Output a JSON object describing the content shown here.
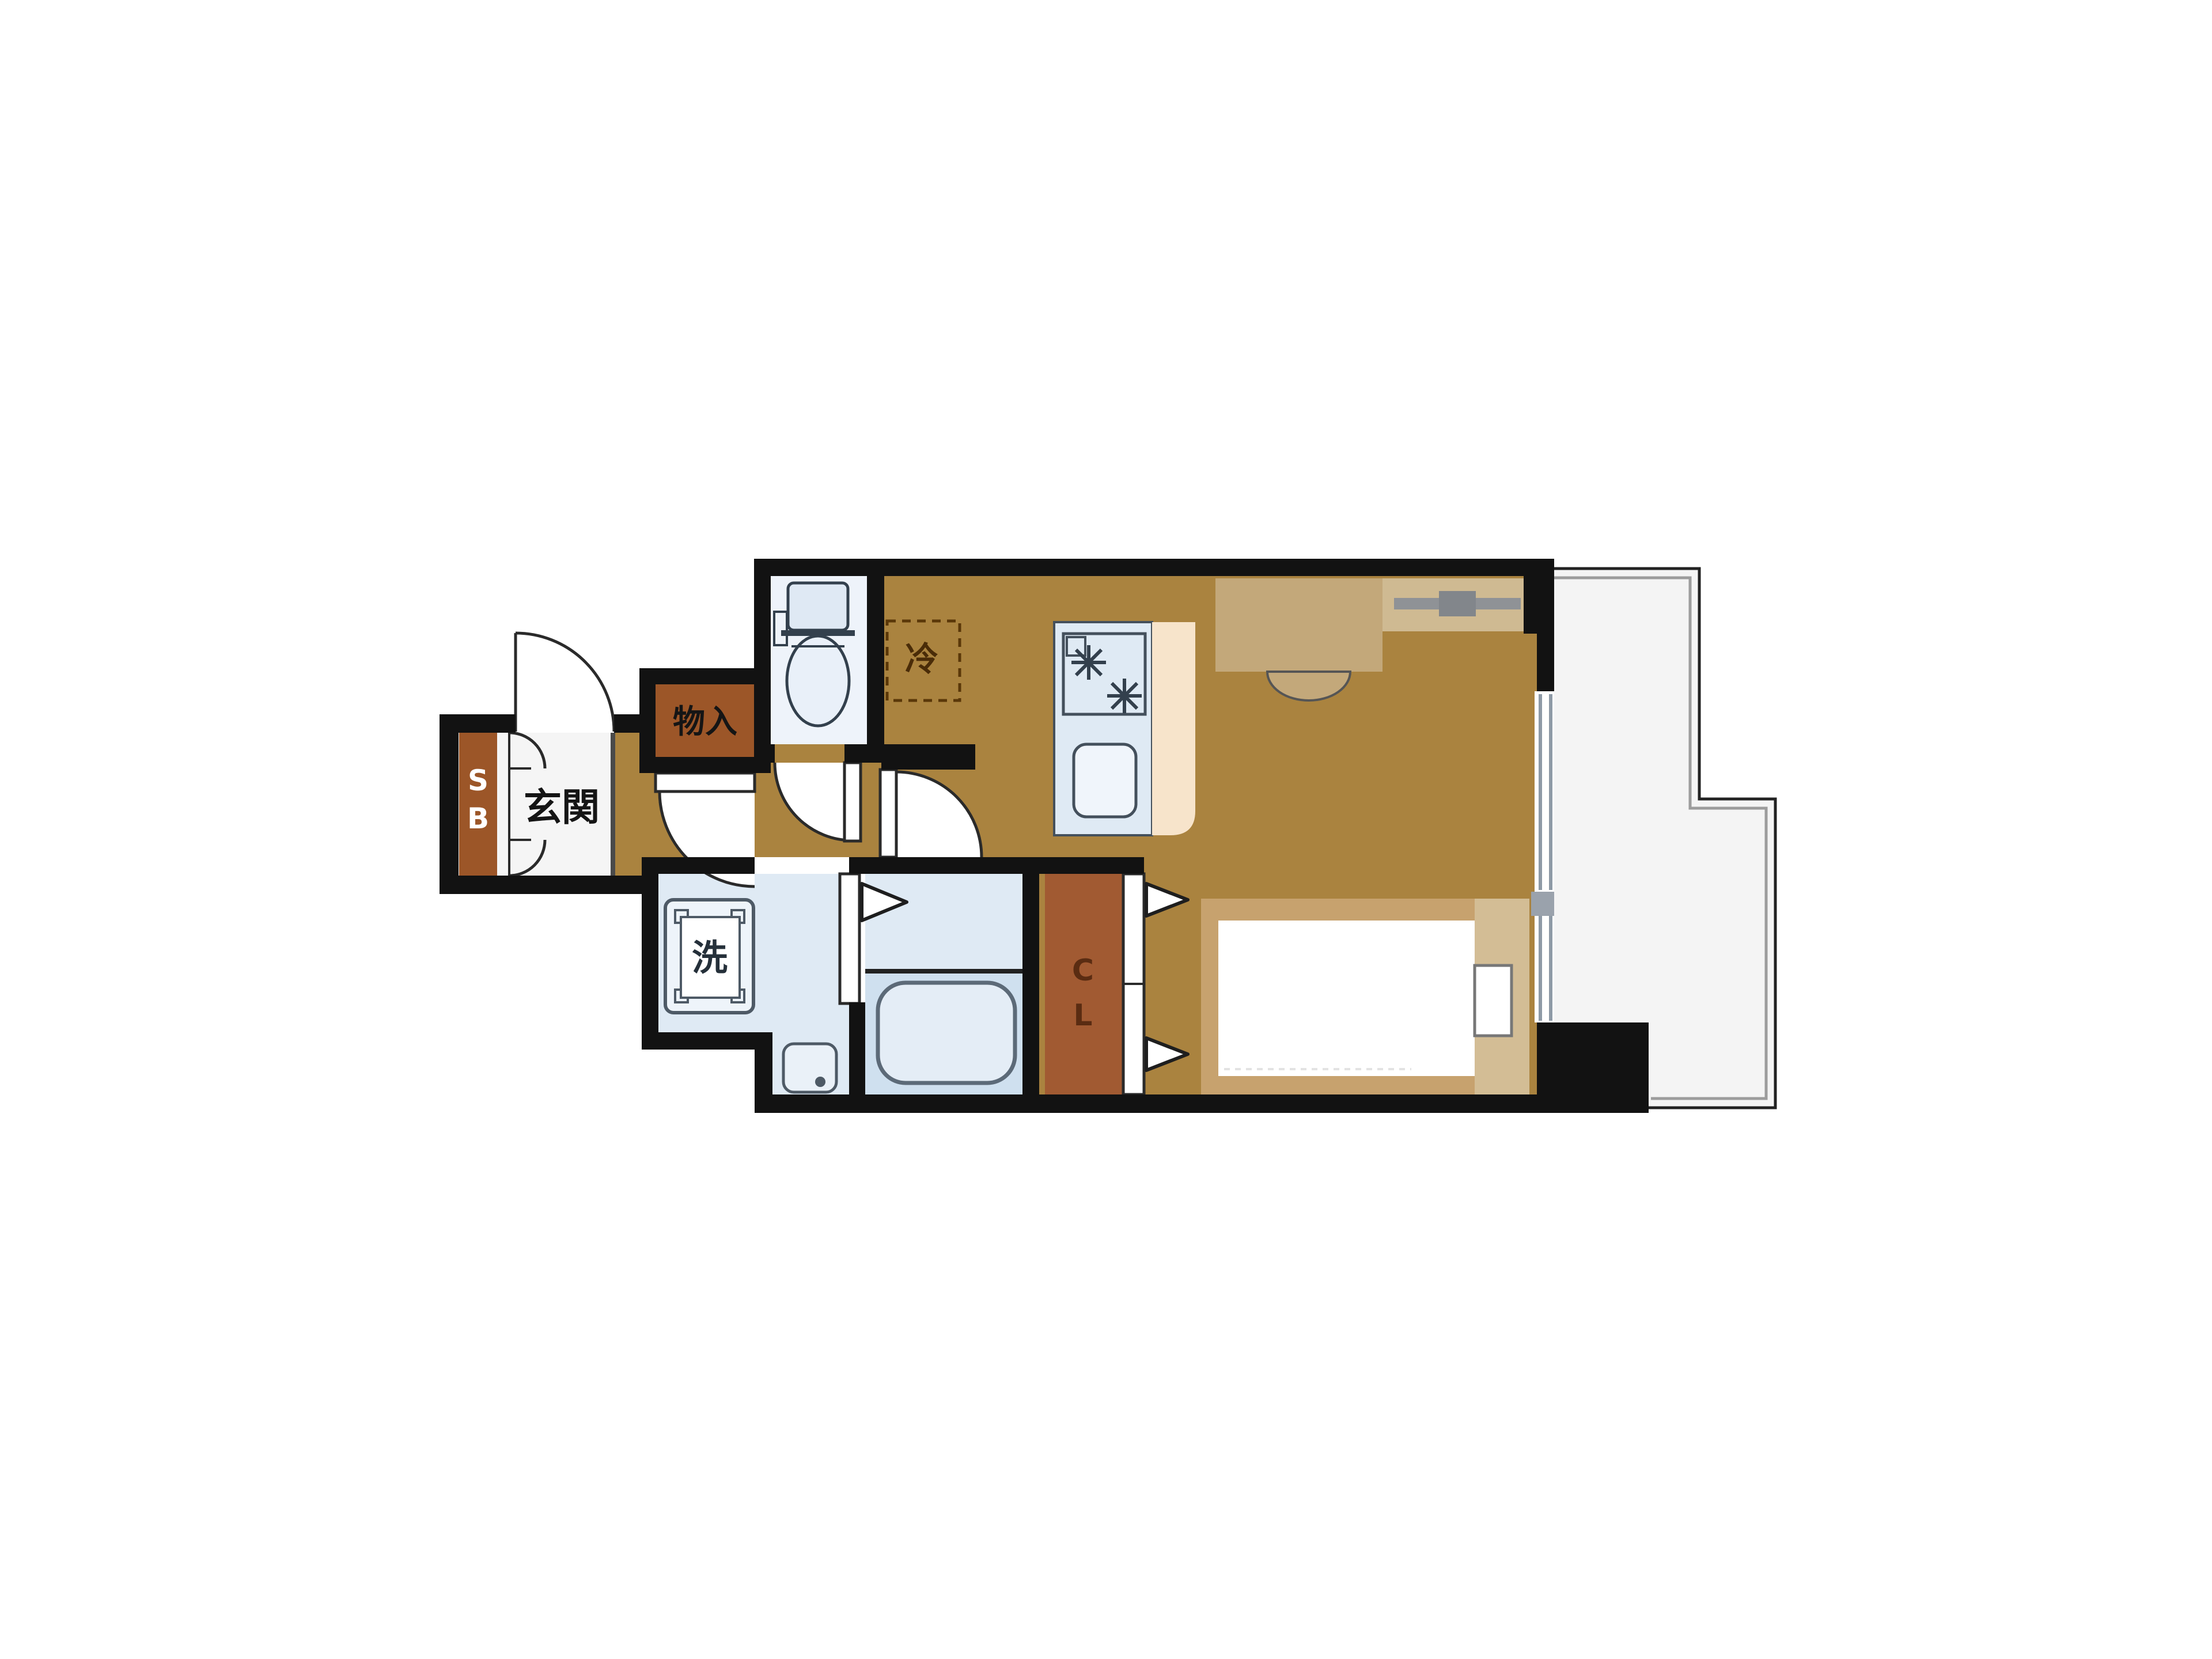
{
  "title": "apartment-floor-plan",
  "labels": {
    "entrance": "玄関",
    "storage": "物入",
    "washer": "洗",
    "refrigerator": "冷",
    "shoe_box": [
      "S",
      "B"
    ],
    "closet": [
      "C",
      "L"
    ]
  },
  "colors": {
    "wall": "#121212",
    "floor": "#aa833f",
    "genkan": "#f5f5f5",
    "cabinet": "#9c5628",
    "closet": "#a15a32",
    "wet": "#dfeaf4",
    "wet_light": "#eef3fa",
    "tub_zone": "#cfe0ef",
    "fixture": "#e9f0f9",
    "peach": "#f7e4cb",
    "balcony": "#f4f4f4",
    "desk": "#c3a87a",
    "hanger": "#cfba92",
    "bed": "#c7a26e",
    "bed_light": "#d3bd95",
    "window_gray": "#8e9aa6"
  }
}
